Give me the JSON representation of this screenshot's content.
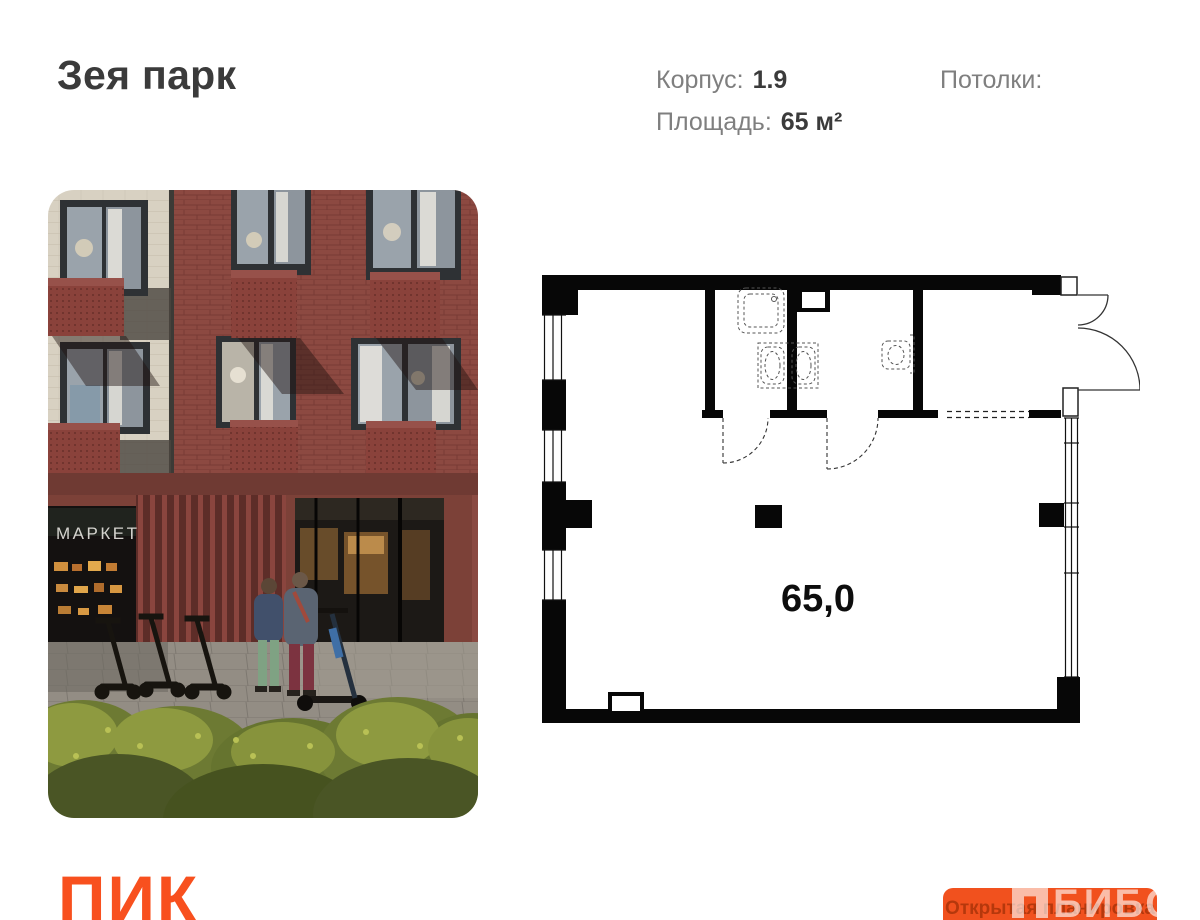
{
  "header": {
    "project_title": "Зея парк",
    "specs": [
      {
        "label": "Корпус:",
        "value": "1.9"
      },
      {
        "label": "Площадь:",
        "value": "65 м²"
      },
      {
        "label": "Потолки:",
        "value": ""
      }
    ]
  },
  "photo": {
    "storefront_sign": "МАРКЕТ"
  },
  "floor_plan": {
    "area_value": "65,0"
  },
  "footer": {
    "brand_logo": "ПИК",
    "brand_color": "#F8501E",
    "open_plan_button": {
      "label": "Открытая планировка",
      "bg": "#F1511E",
      "text_color": "#B5380C"
    },
    "watermark": {
      "text": "БИБОСС",
      "icon": "blocks-logo",
      "color": "rgba(255,255,255,0.62)"
    }
  }
}
